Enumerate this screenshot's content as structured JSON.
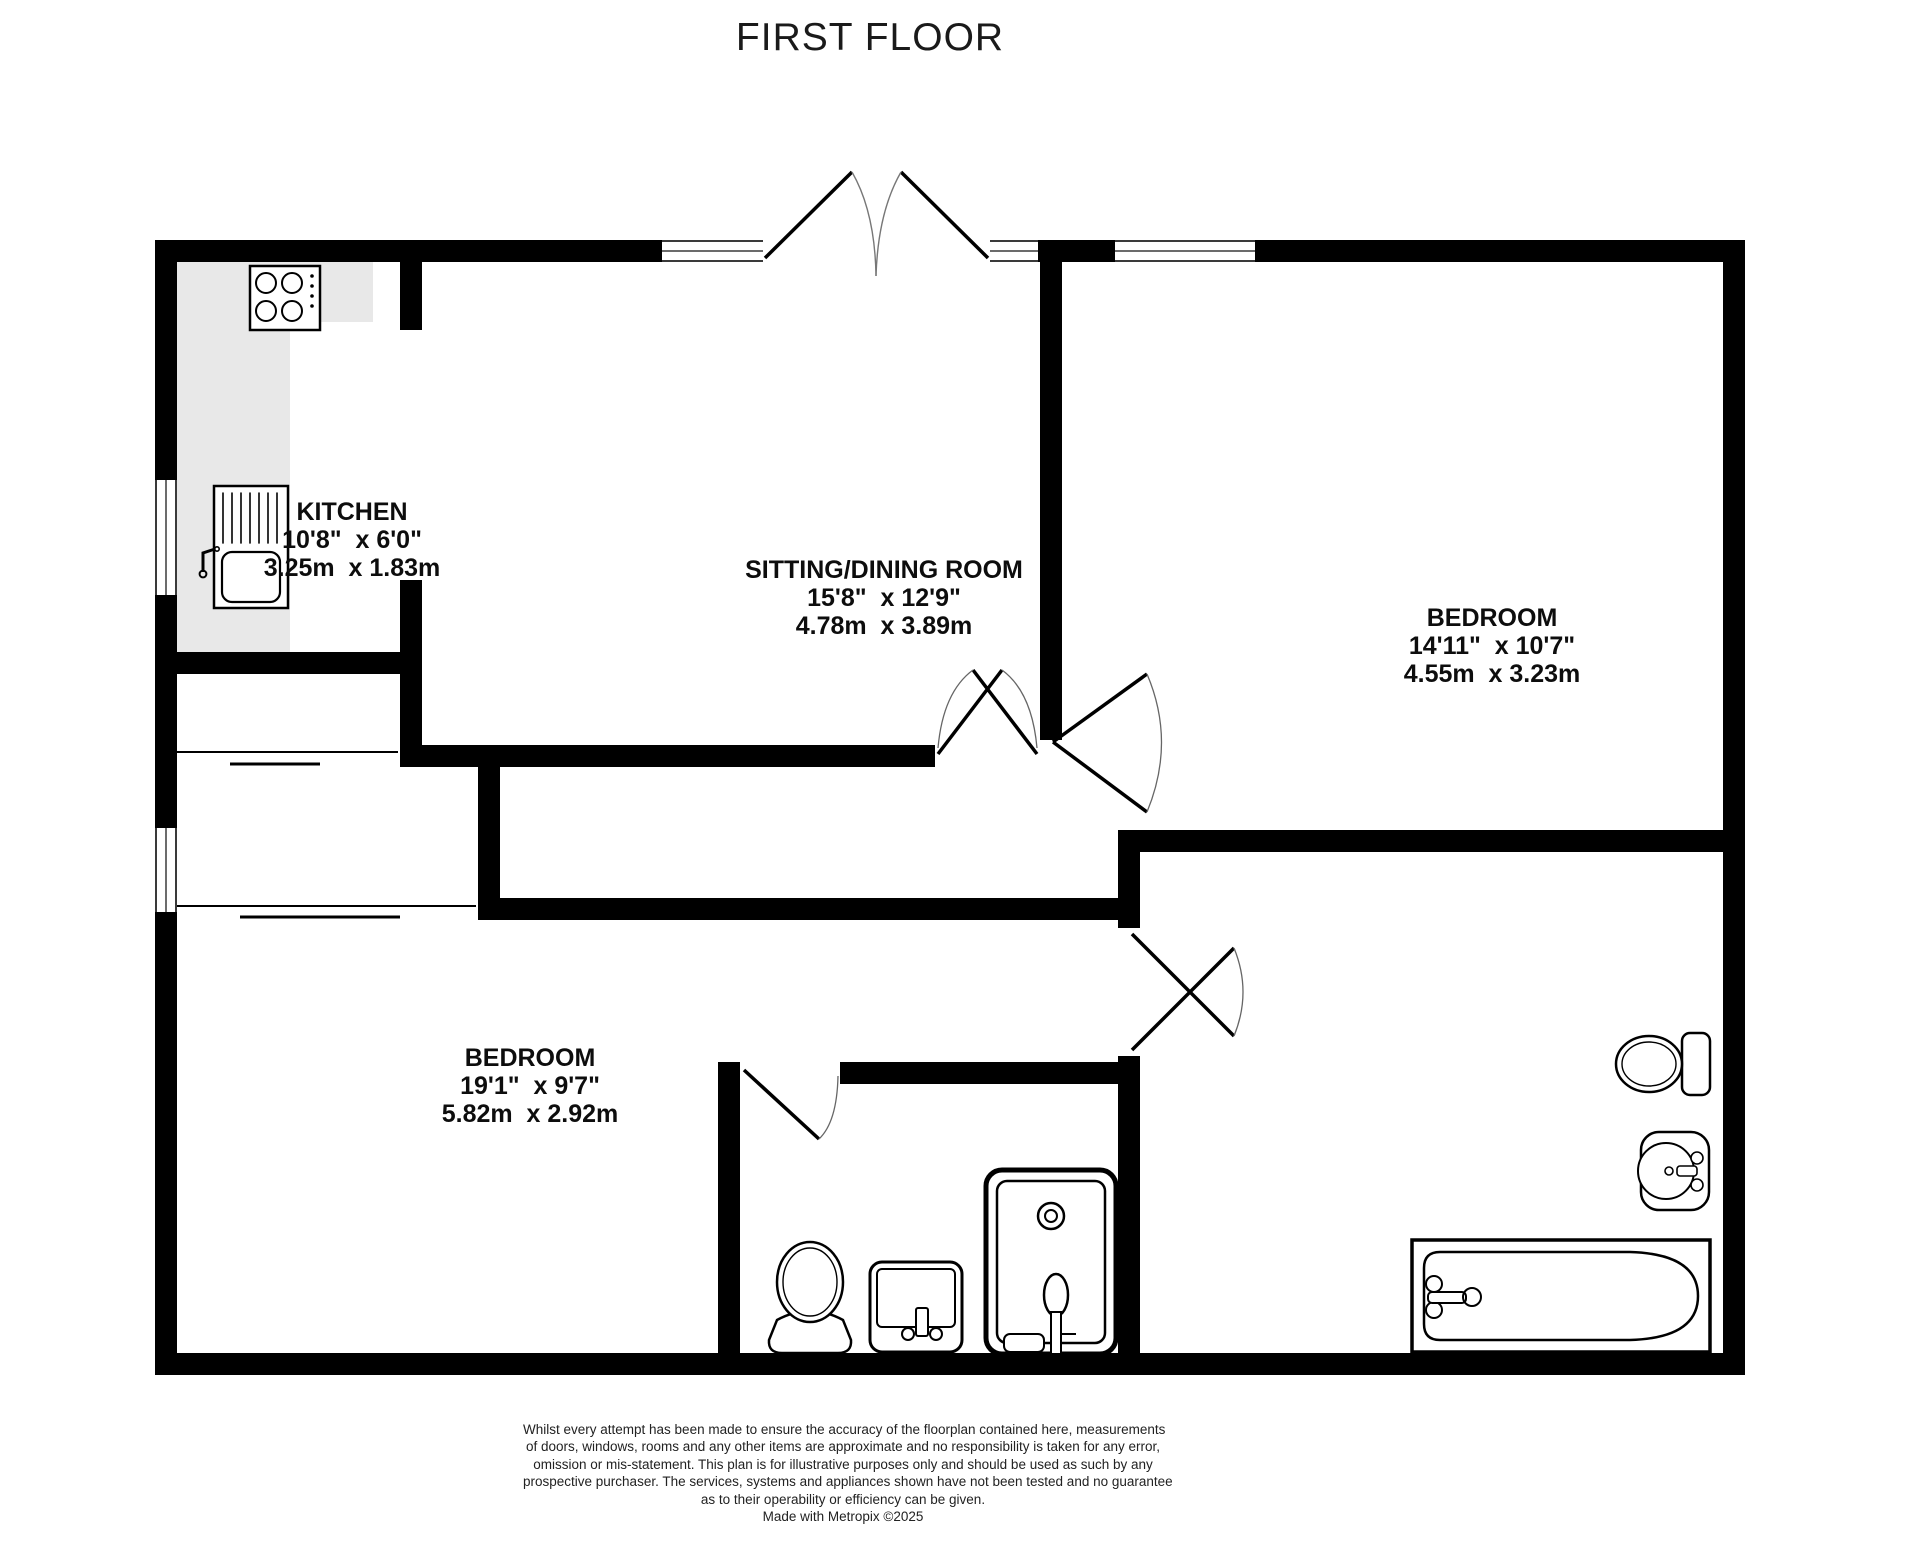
{
  "title": "FIRST FLOOR",
  "rooms": {
    "kitchen": {
      "name": "KITCHEN",
      "imperial": "10'8\"  x 6'0\"",
      "metric": "3.25m  x 1.83m"
    },
    "sitting_dining": {
      "name": "SITTING/DINING ROOM",
      "imperial": "15'8\"  x 12'9\"",
      "metric": "4.78m  x 3.89m"
    },
    "bedroom_right": {
      "name": "BEDROOM",
      "imperial": "14'11\"  x 10'7\"",
      "metric": "4.55m  x 3.23m"
    },
    "bedroom_lower": {
      "name": "BEDROOM",
      "imperial": "19'1\"  x 9'7\"",
      "metric": "5.82m  x 2.92m"
    }
  },
  "disclaimer": {
    "lines": [
      "Whilst every attempt has been made to ensure the accuracy of the floorplan contained here, measurements",
      "of doors, windows, rooms and any other items are approximate and no responsibility is taken for any error,",
      "omission or mis-statement. This plan is for illustrative purposes only and should be used as such by any",
      "prospective purchaser. The services, systems and appliances shown have not been tested and no guarantee",
      "as to their operability or efficiency can be given.",
      "Made with Metropix ©2025"
    ]
  },
  "fixtures": [
    "hob",
    "kitchen-sink",
    "toilet",
    "washbasin",
    "shower",
    "bathtub",
    "radiator-drainer"
  ],
  "colors": {
    "wall": "#000000",
    "counter": "#e8e8e8",
    "window_line": "#3a3a3a",
    "door_arc": "#666666"
  }
}
